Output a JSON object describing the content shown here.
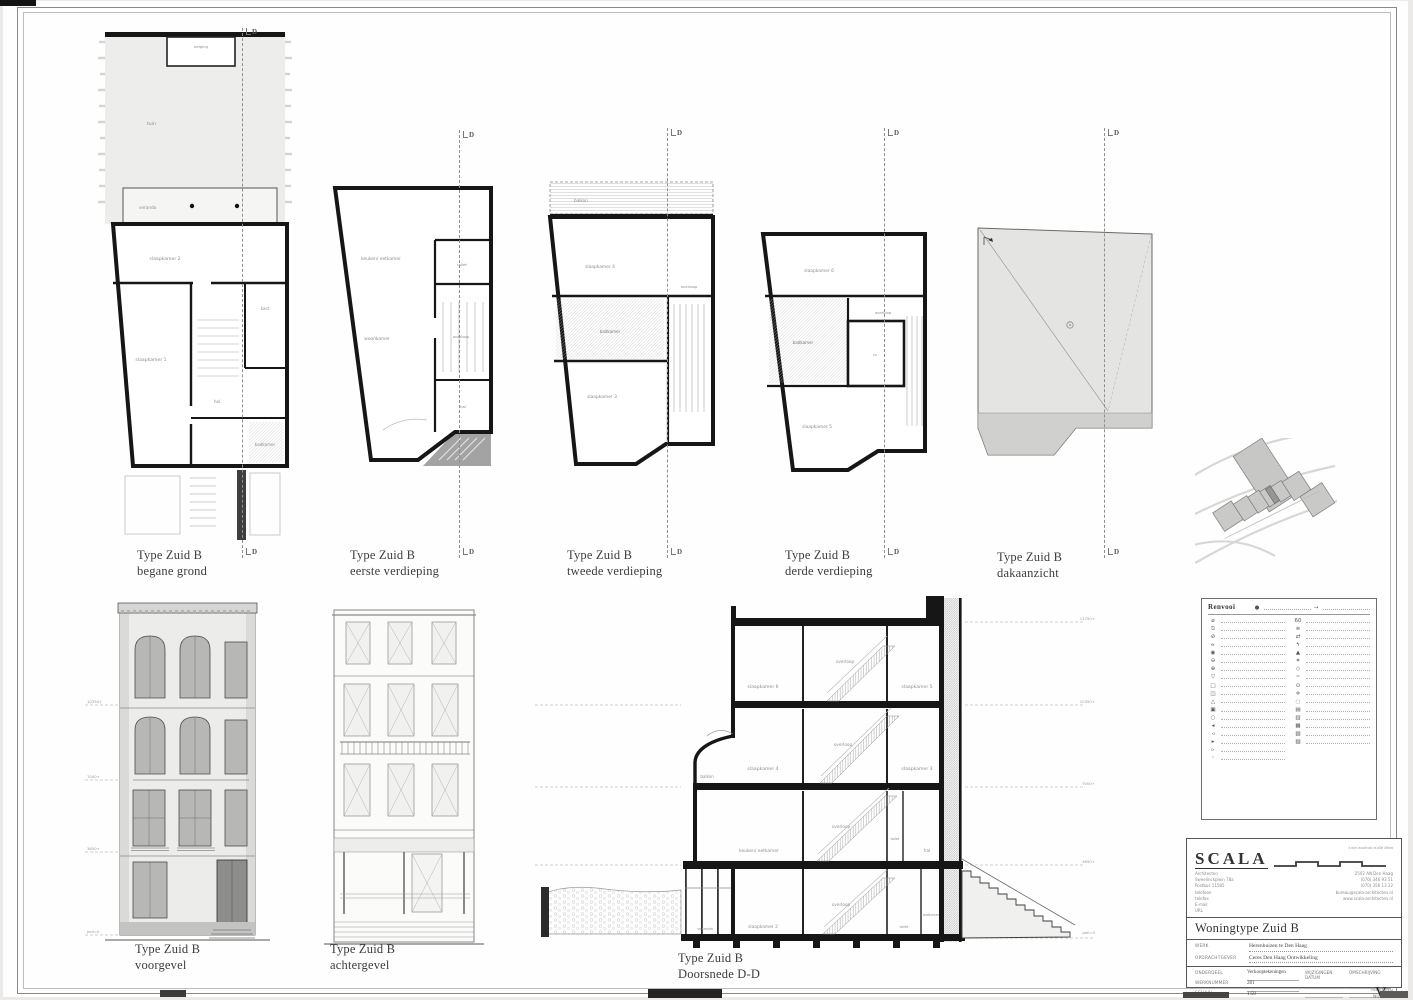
{
  "section_marker": "D",
  "captions": {
    "begane_grond": {
      "l1": "Type Zuid B",
      "l2": "begane grond"
    },
    "eerste": {
      "l1": "Type Zuid B",
      "l2": "eerste verdieping"
    },
    "tweede": {
      "l1": "Type Zuid B",
      "l2": "tweede verdieping"
    },
    "derde": {
      "l1": "Type Zuid B",
      "l2": "derde verdieping"
    },
    "dak": {
      "l1": "Type Zuid B",
      "l2": "dakaanzicht"
    },
    "voorgevel": {
      "l1": "Type Zuid B",
      "l2": "voorgevel"
    },
    "achtergevel": {
      "l1": "Type Zuid B",
      "l2": "achtergevel"
    },
    "doorsnede": {
      "l1": "Type Zuid B",
      "l2": "Doorsnede D-D"
    }
  },
  "plan_rooms": {
    "begane_grond": {
      "tuin": "tuin",
      "berging": "berging",
      "veranda": "veranda",
      "sk2": "slaapkamer 2",
      "sk1": "slaapkamer 1",
      "kast": "kast",
      "badkamer": "badkamer",
      "hal": "hal"
    },
    "eerste": {
      "keuken": "keuken/ eetkamer",
      "woonkamer": "woonkamer",
      "toilet": "toilet",
      "overloop": "overloop",
      "hal": "hal"
    },
    "tweede": {
      "balkon": "balkon",
      "sk4": "slaapkamer 4",
      "badkamer": "badkamer",
      "overloop": "overloop",
      "sk3": "slaapkamer 3"
    },
    "derde": {
      "sk6": "slaapkamer 6",
      "badkamer": "badkamer",
      "overloop": "overloop",
      "cv": "cv",
      "sk5": "slaapkamer 5"
    }
  },
  "section_rooms": {
    "f3": {
      "a": "slaapkamer 6",
      "b": "overloop",
      "c": "slaapkamer 5"
    },
    "f2": {
      "balkon": "balkon",
      "a": "slaapkamer 4",
      "b": "overloop",
      "c": "slaapkamer 3"
    },
    "f1": {
      "a": "keuken/ eetkamer",
      "b": "overloop",
      "t": "toilet",
      "c": "hal"
    },
    "f0": {
      "v": "veranda",
      "a": "slaapkamer 2",
      "b": "overloop",
      "t": "toilet",
      "c": "badkamer"
    }
  },
  "levels": {
    "l0": "peil=0",
    "l1": "3650+",
    "l2": "7000+",
    "l3": "10350+",
    "l4": "13750+"
  },
  "legend": {
    "title": "Renvooi"
  },
  "titleblock": {
    "logo": "SCALA",
    "note": "± niet maatvast in alle delen",
    "address_left": [
      "Architecten",
      "Sweelinckplein 78a",
      "Postbus 11585",
      "telefoon",
      "telefax",
      "E-mail",
      "URL"
    ],
    "address_right": [
      "2502 AN Den Haag",
      "(070) 346 93 51",
      "(070) 356 13 22",
      "bureau@scala-architecten.nl",
      "www.scala-architecten.nl"
    ],
    "project_title": "Woningtype Zuid B",
    "werk_label": "WERK",
    "werk": "Herenhuizen te Den Haag",
    "opdrachtgever_label": "OPDRACHTGEVER",
    "opdrachtgever": "Ceres Den Haag Ontwikkeling",
    "onderdeel_label": "ONDERDEEL",
    "onderdeel": "Verkooptekeningen",
    "werknummer_label": "WERKNUMMER",
    "werknummer": "281",
    "schaal_label": "SCHAAL",
    "schaal": "1:50",
    "datum_label": "DATUM",
    "datum": "21 februari 2000",
    "wijzigingen_label": "WIJZIGINGEN",
    "wijz_datum_label": "DATUM",
    "omschrijving_label": "OMSCHRIJVING",
    "tekening_label1": "TEKENING",
    "tekening_label2": "NUMMER",
    "nummer": "V-16",
    "footnote": "ACAD tek. V16b   pagina 000213"
  }
}
